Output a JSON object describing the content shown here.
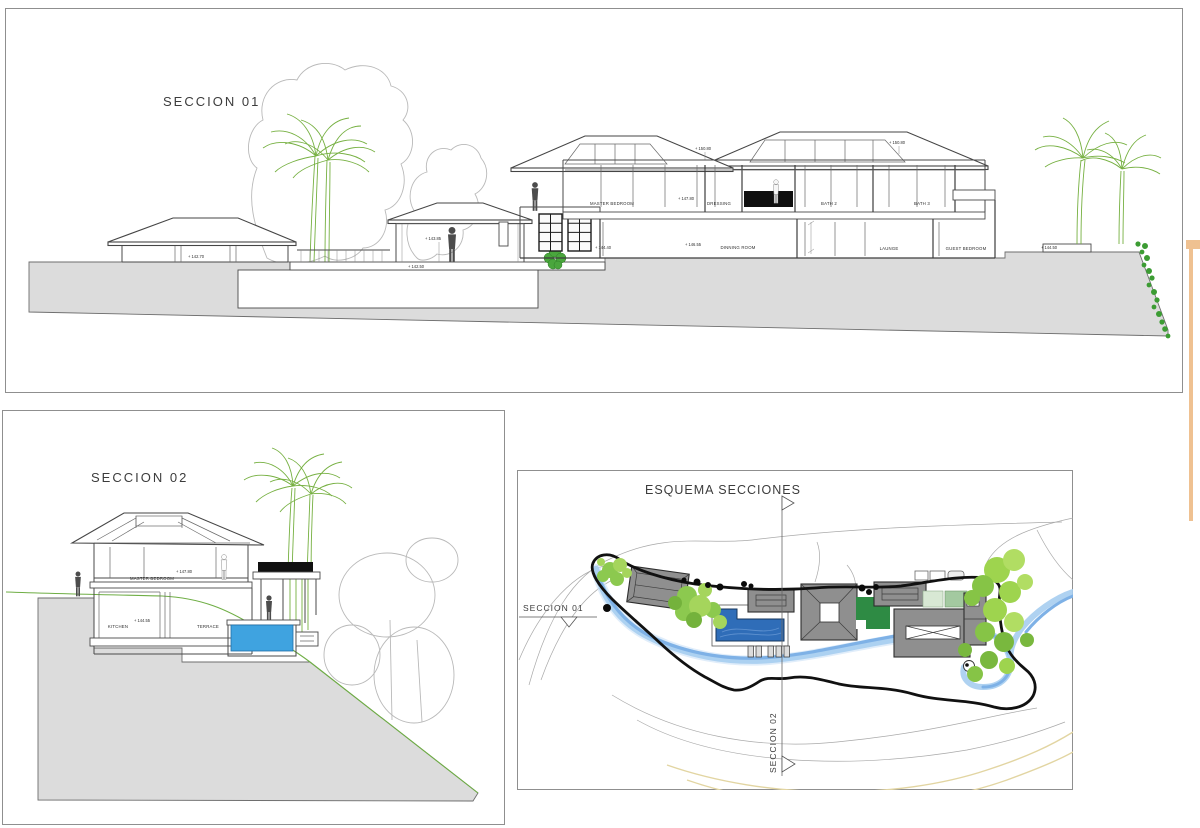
{
  "panels": {
    "seccion01": {
      "title": "SECCION 01",
      "rooms": {
        "master_bedroom": "MASTER BEDROOM",
        "dressing": "DRESSING",
        "bath2": "BATH 2",
        "bath3": "BATH 3",
        "dinning_room": "DINNING ROOM",
        "launge": "LAUNGE",
        "guest_bedroom": "GUEST BEDROOM"
      },
      "elevations": {
        "ground_left": "+ 142.70",
        "pavilion": "+ 143.85",
        "terrace": "+ 142.50",
        "entry": "+ 144.40",
        "upper_floor": "+ 147.80",
        "dinning": "+ 146.55",
        "right_platform": "+ 144.50",
        "roof_left": "+ 150.80",
        "roof_right": "+ 150.80"
      }
    },
    "seccion02": {
      "title": "SECCION 02",
      "rooms": {
        "master_bedroom": "MASTER BEDROOM",
        "kitchen": "KITCHEN",
        "terrace": "TERRACE"
      },
      "elevations": {
        "master_floor": "+ 147.80",
        "kitchen_floor": "+ 144.55"
      }
    },
    "esquema": {
      "title": "ESQUEMA SECCIONES",
      "section01_label": "SECCION 01",
      "section02_label": "SECCION 02"
    }
  },
  "colors": {
    "ground_gray": "#dcdcdc",
    "roof_gray": "#8f8f8f",
    "pool_blue_section": "#3fa3e0",
    "pool_blue_plan": "#2f6db8",
    "stream_blue": "#7eb1e6",
    "lawn_green": "#2e8b44",
    "tree_green": "#8cc94f",
    "palm_green": "#76b041",
    "contour_tan": "#e2d5a2",
    "boundary_black": "#111111",
    "adjacent_sheet_orange": "#efc191"
  }
}
